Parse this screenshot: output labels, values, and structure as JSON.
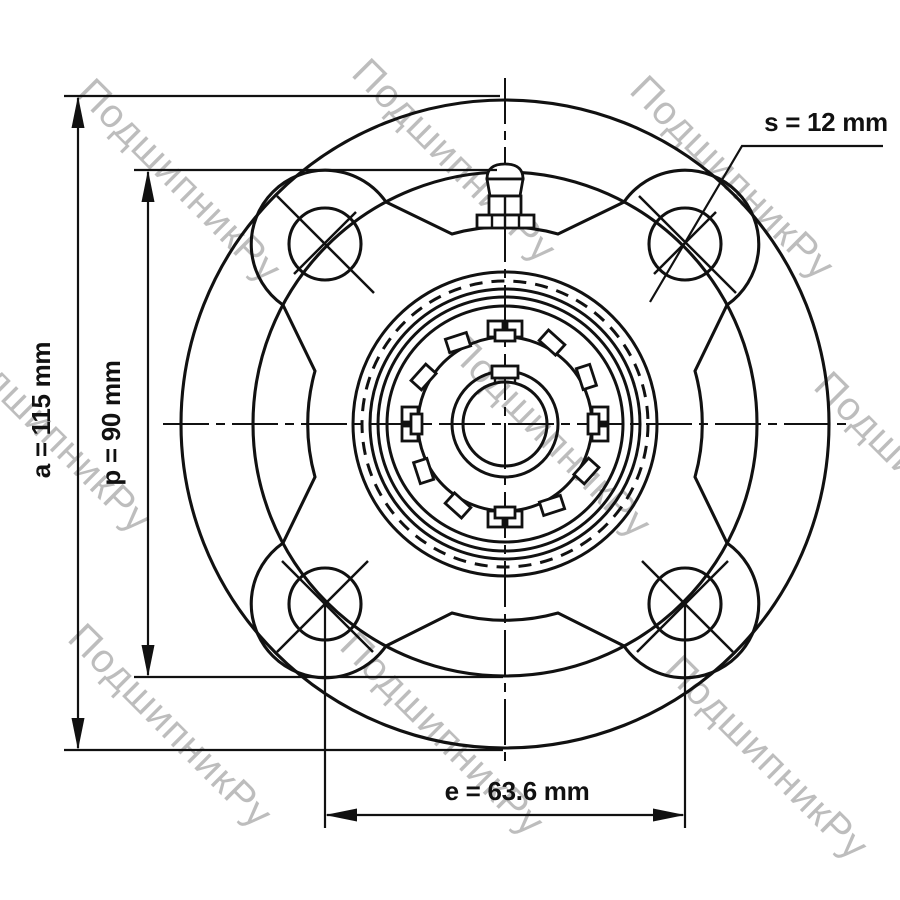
{
  "diagram": {
    "type": "technical-drawing",
    "view": "front view of 4-bolt round flange bearing unit with eccentric locking collar and grease fitting",
    "dimensions": {
      "a": {
        "symbol": "a",
        "value": 115,
        "unit": "mm",
        "label": "a = 115 mm",
        "describes": "flange outer diameter (vertical overall)"
      },
      "p": {
        "symbol": "p",
        "value": 90,
        "unit": "mm",
        "label": "p = 90 mm",
        "describes": "bolt circle / boss diameter (vertical)"
      },
      "s": {
        "symbol": "s",
        "value": 12,
        "unit": "mm",
        "label": "s = 12 mm",
        "describes": "mounting bolt hole diameter"
      },
      "e": {
        "symbol": "e",
        "value": 63.6,
        "unit": "mm",
        "label": "e = 63.6 mm",
        "describes": "horizontal spacing between adjacent bolt hole centers"
      }
    },
    "watermark": {
      "text": "ПодшипникРу",
      "color": "#bdbdbd"
    },
    "colors": {
      "line": "#111111",
      "background": "#ffffff"
    }
  }
}
